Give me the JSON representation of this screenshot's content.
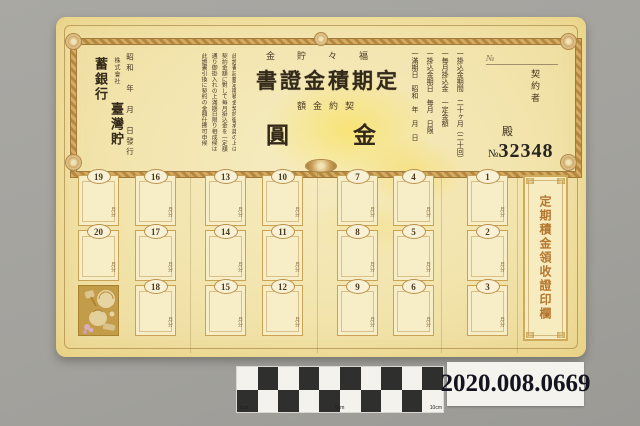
{
  "colors": {
    "photo_background": "#a3a29d",
    "paper": "#f2e4ac",
    "frame_gold": "#c79a52",
    "panel_text": "#b5762e",
    "catalog_text": "#14141e"
  },
  "certificate": {
    "header": {
      "product_name": "金貯々福",
      "title": "書證金積期定",
      "amount_label": "額金約契",
      "amount_left": "圓",
      "amount_right": "金"
    },
    "issuer": {
      "company_type": "株式會社",
      "bank_name": "臺灣貯蓄銀行",
      "date_line": "昭和　年　月　日發行"
    },
    "conditions": [
      "此證書記載定期積金契約御承諾の上は",
      "契約金額に對して毎月掛込金を一定額",
      "通り御掛入れの上滿期日限り相成候は",
      "此證書引換に契約の金額仕拂可申候"
    ],
    "terms": [
      "一掛込金期間　二十ヶ月（二十回）",
      "一毎月掛込金　一定金額",
      "一掛込金期日　毎月　日限",
      "一滿期日　昭和　年　月　日"
    ],
    "contractor": {
      "no_prefix": "№",
      "label": "契約者",
      "honorific": "殿"
    },
    "serial": {
      "prefix": "№",
      "number": "32348"
    },
    "coupons": {
      "unit_label": "月分",
      "columns": [
        {
          "cells": [
            "19",
            "20"
          ]
        },
        {
          "cells": [
            "16",
            "17",
            "18"
          ]
        },
        {
          "cells": [
            "13",
            "14",
            "15"
          ]
        },
        {
          "cells": [
            "10",
            "11",
            "12"
          ]
        },
        {
          "cells": [
            "7",
            "8",
            "9"
          ]
        },
        {
          "cells": [
            "4",
            "5",
            "6"
          ]
        },
        {
          "cells": [
            "1",
            "2",
            "3"
          ]
        }
      ]
    },
    "right_panel": {
      "text": "定期積金領收證印欄"
    }
  },
  "scale_bar": {
    "labels": {
      "left": "1cm",
      "middle": "5cm",
      "right": "10cm"
    }
  },
  "catalog_label": {
    "number": "2020.008.0669"
  }
}
